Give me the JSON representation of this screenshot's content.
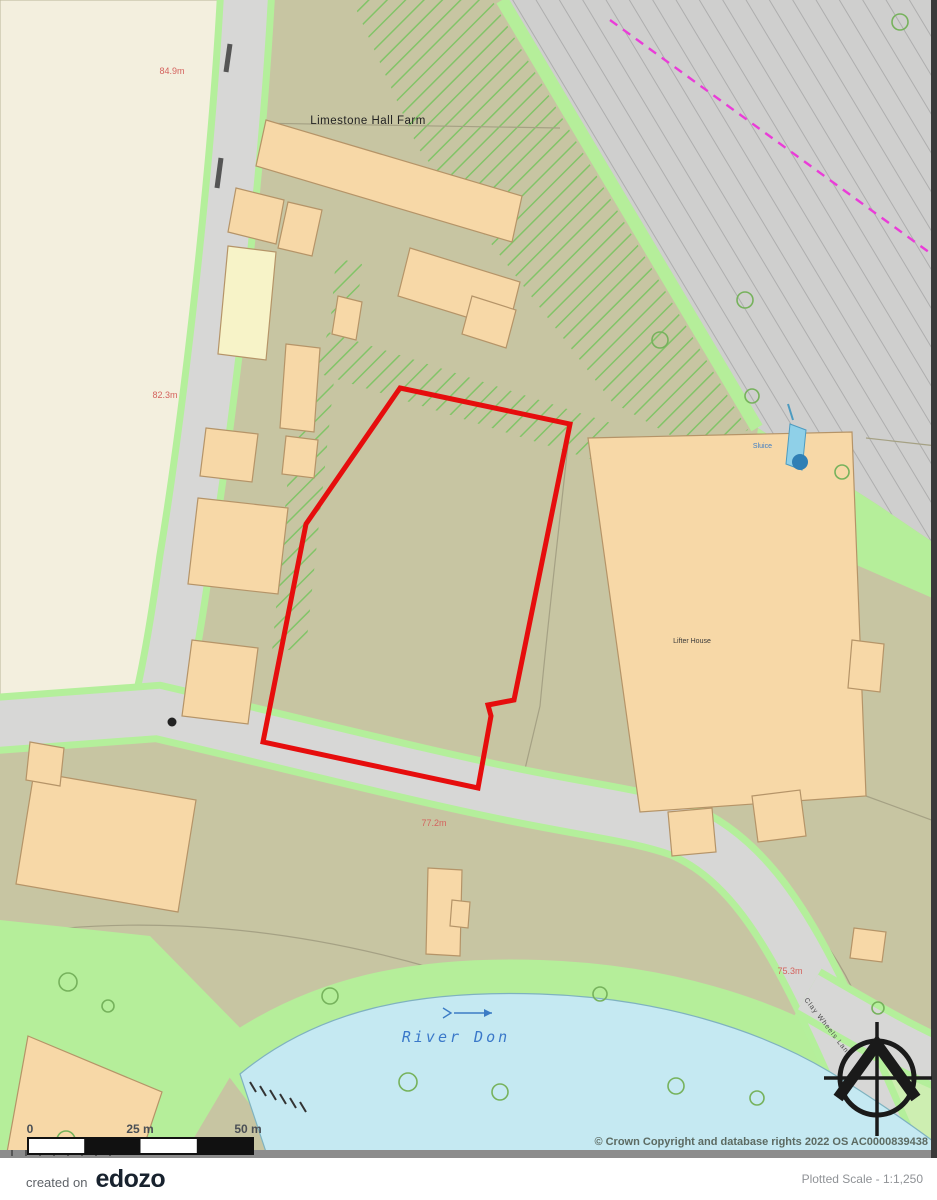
{
  "map": {
    "labels": {
      "farm_name": "Limestone Hall Farm",
      "house_name": "Lifter House",
      "river_name": "River Don",
      "sluice": "Sluice",
      "lane_name": "Clay Wheels Lane",
      "spot_heights": [
        "84.9m",
        "82.3m",
        "77.2m",
        "75.3m"
      ]
    },
    "scale_bar": {
      "zero": "0",
      "mid": "25 m",
      "end": "50 m"
    },
    "copyright": "© Crown Copyright and database rights 2022 OS AC0000839438",
    "colors": {
      "site_boundary": "#e60d0d",
      "buildings": "#f7d8a7",
      "water": "#c5e9f2",
      "vegetation": "#b5ee9a",
      "road": "#d7d7d6"
    }
  },
  "footer": {
    "created_on": "created on",
    "brand": "edozo",
    "plotted_scale": "Plotted Scale - 1:1,250"
  }
}
